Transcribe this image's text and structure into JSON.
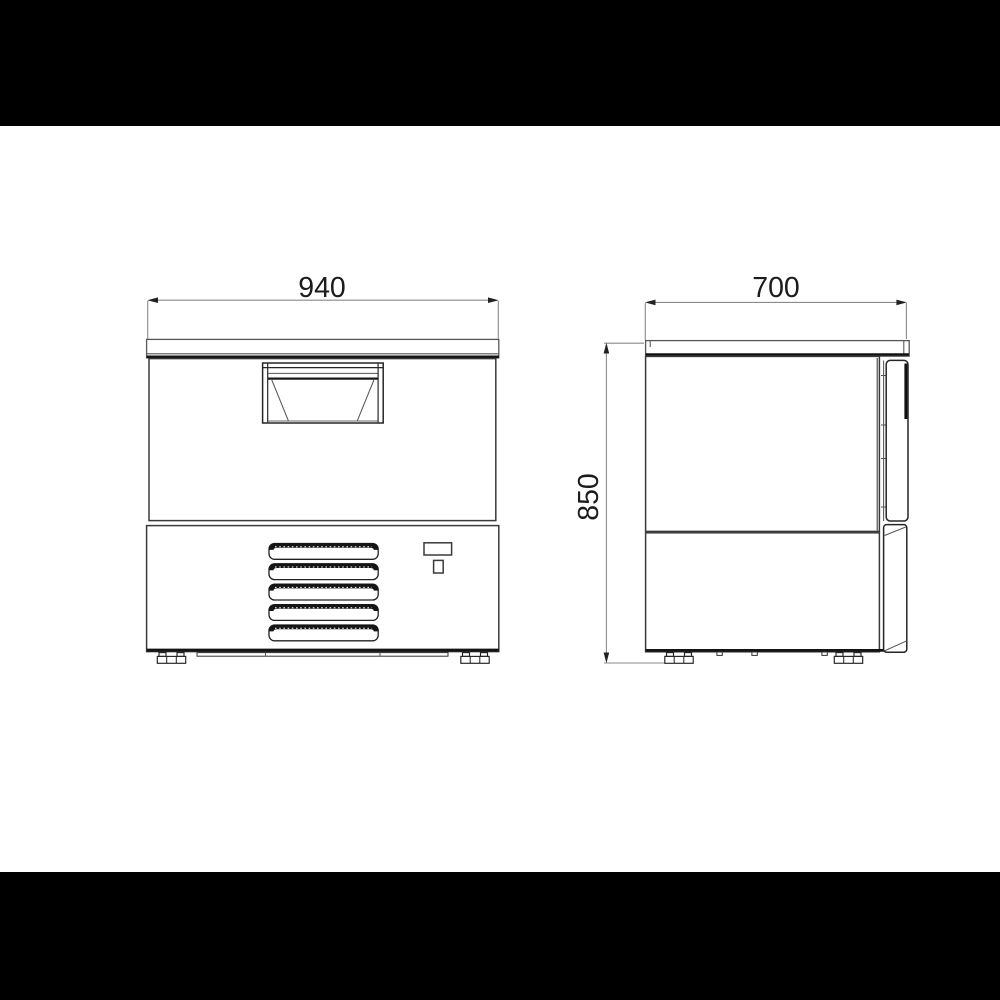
{
  "page": {
    "letterbox_color": "#000000",
    "paper_color": "#ffffff",
    "line_color": "#2e2e2e",
    "text_color": "#1c1c1c"
  },
  "dimensions": {
    "front_width": "940",
    "side_depth": "700",
    "side_height": "850"
  }
}
